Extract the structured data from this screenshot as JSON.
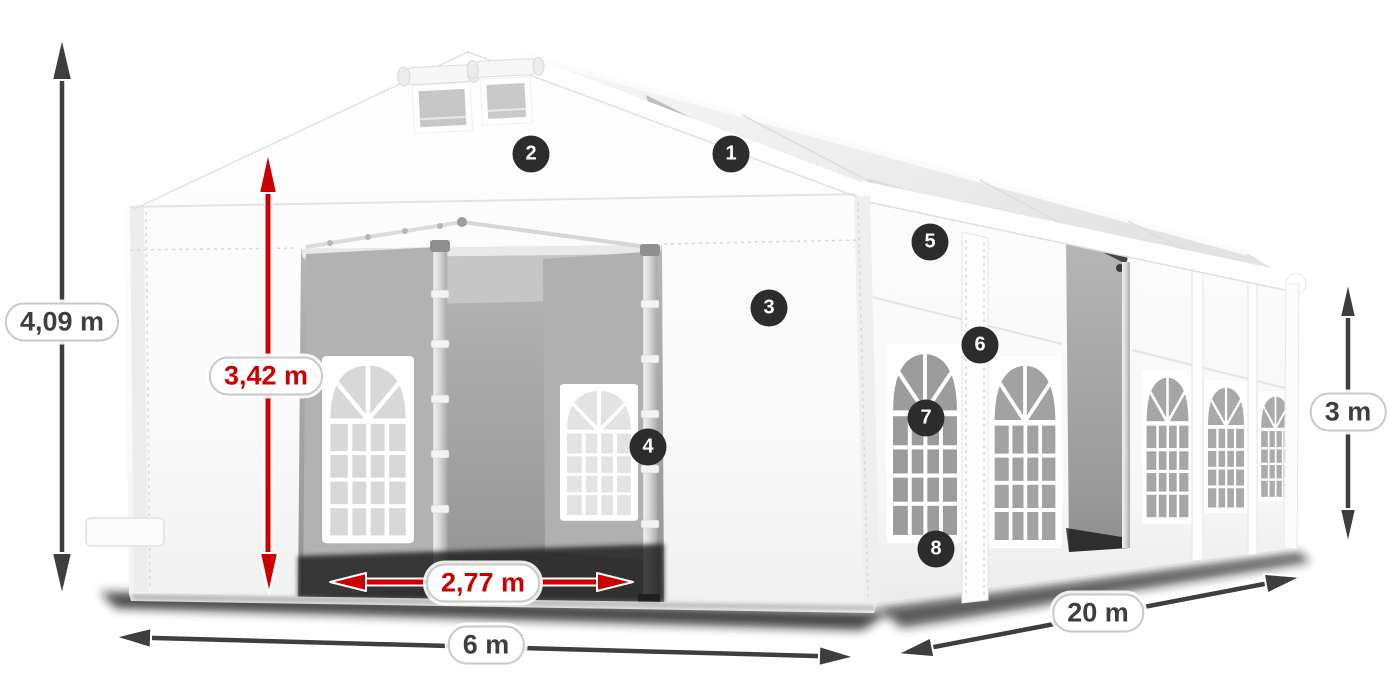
{
  "colors": {
    "accent_red": "#cc0000",
    "dimension_dark": "#3e3e3e",
    "badge_bg": "#2c2c2c",
    "badge_text": "#ffffff",
    "label_bg": "#ffffff",
    "label_border": "#c9c9c9"
  },
  "dimensions": {
    "total_height": "4,09 m",
    "entrance_height": "3,42 m",
    "entrance_width": "2,77 m",
    "front_width": "6 m",
    "side_length": "20 m",
    "wall_height": "3 m"
  },
  "markers": [
    "1",
    "2",
    "3",
    "4",
    "5",
    "6",
    "7",
    "8"
  ]
}
